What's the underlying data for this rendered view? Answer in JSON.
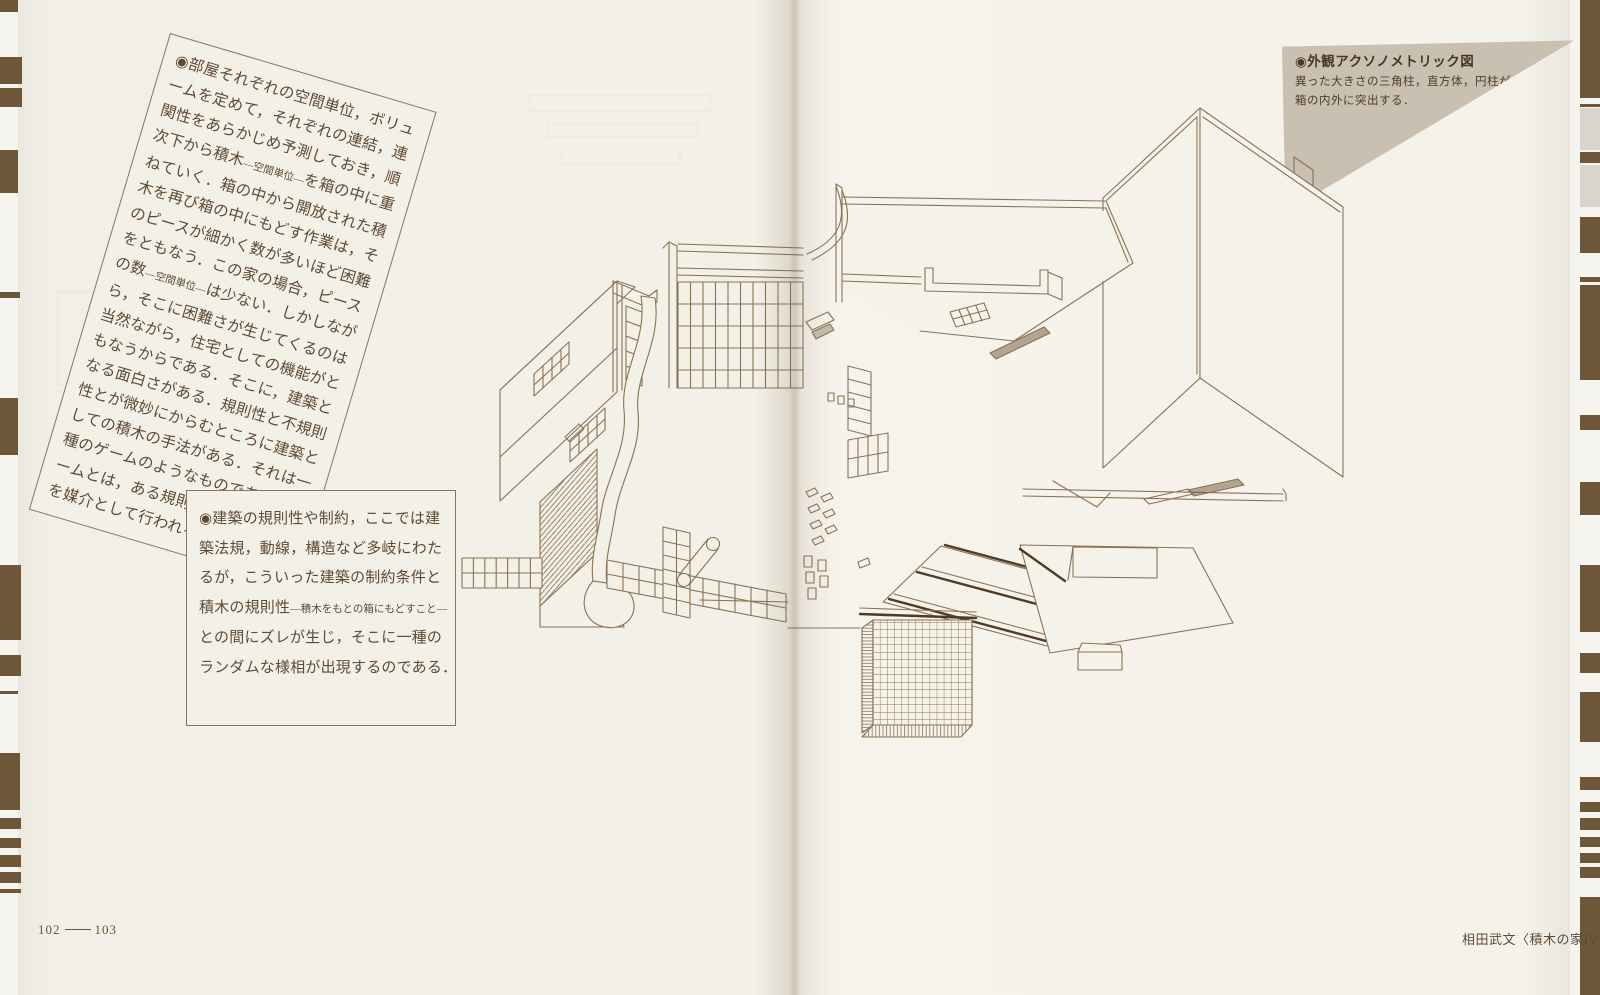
{
  "document": {
    "left_page_number": "102",
    "right_page_number": "103",
    "footer_caption": "相田武文〈積木の家IV〉"
  },
  "tilted_note": {
    "lines": [
      [
        {
          "t": "◉部屋それぞれの空間単位，ボリュ"
        }
      ],
      [
        {
          "t": "ームを定めて，それぞれの連結，連"
        }
      ],
      [
        {
          "t": "関性をあらかじめ予測しておき，順"
        }
      ],
      [
        {
          "t": "次下から積木"
        },
        {
          "t": "—空間単位—",
          "small": true
        },
        {
          "t": "を箱の中に重"
        }
      ],
      [
        {
          "t": "ねていく．箱の中から開放された積"
        }
      ],
      [
        {
          "t": "木を再び箱の中にもどす作業は，そ"
        }
      ],
      [
        {
          "t": "のピースが細かく数が多いほど困難"
        }
      ],
      [
        {
          "t": "をともなう．この家の場合，ピース"
        }
      ],
      [
        {
          "t": "の数"
        },
        {
          "t": "—空間単位—",
          "small": true
        },
        {
          "t": "は少ない．しかしなが"
        }
      ],
      [
        {
          "t": "ら，そこに困難さが生じてくるのは"
        }
      ],
      [
        {
          "t": "当然ながら，住宅としての機能がと"
        }
      ],
      [
        {
          "t": "もなうからである．そこに，建築と"
        }
      ],
      [
        {
          "t": "なる面白さがある．規則性と不規則"
        }
      ],
      [
        {
          "t": "性とが微妙にからむところに建築と"
        }
      ],
      [
        {
          "t": "しての積木の手法がある．それは一"
        }
      ],
      [
        {
          "t": "種のゲームのようなものである．ゲ"
        }
      ],
      [
        {
          "t": "ームとは，ある規則性の中で偶然性"
        }
      ],
      [
        {
          "t": "を媒介として行われるものである．"
        }
      ]
    ]
  },
  "square_note": {
    "lines": [
      [
        {
          "t": "◉建築の規則性や制約，ここでは建"
        }
      ],
      [
        {
          "t": "築法規，動線，構造など多岐にわた"
        }
      ],
      [
        {
          "t": "るが，こういった建築の制約条件と"
        }
      ],
      [
        {
          "t": "積木の規則性"
        },
        {
          "t": "—積木をもとの箱にもどすこと—",
          "small": true
        }
      ],
      [
        {
          "t": "との間にズレが生じ，そこに一種の"
        }
      ],
      [
        {
          "t": "ランダムな様相が出現するのである．"
        }
      ]
    ]
  },
  "figure_callout": {
    "title": "◉外観アクソノメトリック図",
    "body": [
      "異った大きさの三角柱，直方体，円柱が",
      "箱の内外に突出する．"
    ]
  },
  "colors": {
    "paper": "#f3f0e8",
    "ink_line": "#8a7254",
    "text_ink": "#5f4a33",
    "edge_stripe_brown": "#6d5738",
    "edge_stripe_gray": "#d9d5cd",
    "callout_tint": "#c9c0b2",
    "dark_rail": "#4e3c27"
  }
}
